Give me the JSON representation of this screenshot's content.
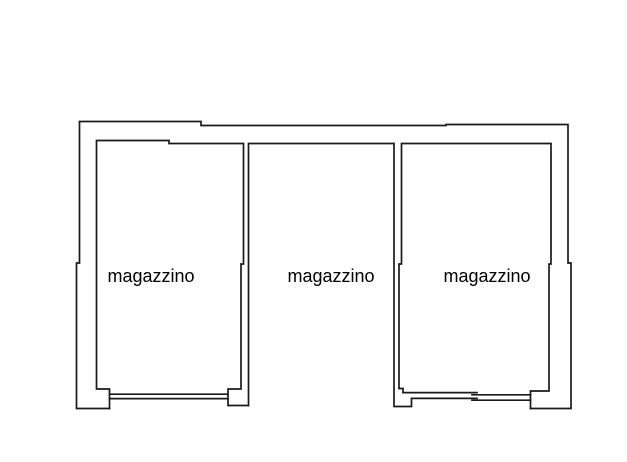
{
  "canvas": {
    "background_color": "#ffffff",
    "line_color": "#1a1a1a",
    "text_color": "#000000"
  },
  "plan": {
    "kind": "floor-plan",
    "rooms": [
      {
        "id": "left",
        "label": "magazzino"
      },
      {
        "id": "center",
        "label": "magazzino"
      },
      {
        "id": "right",
        "label": "magazzino"
      }
    ]
  }
}
